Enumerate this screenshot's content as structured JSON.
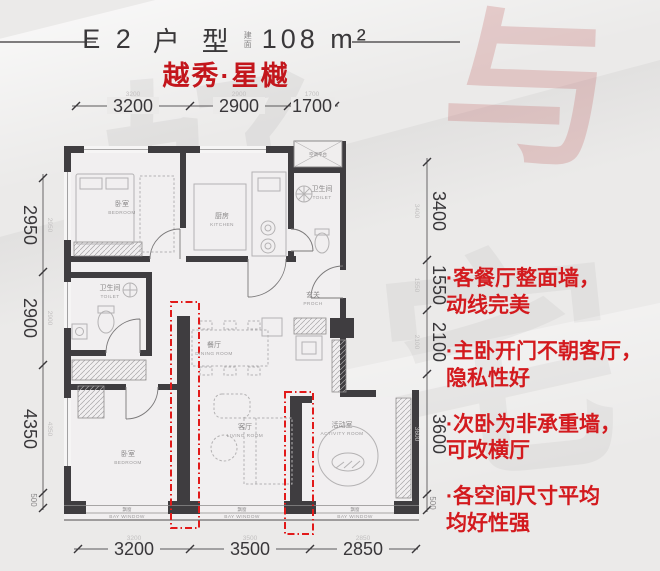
{
  "header": {
    "unit": "E 2",
    "char1": "户",
    "char2": "型",
    "area_label": "建面",
    "area_value": "108 m²",
    "subtitle": "越秀·星樾"
  },
  "dims": {
    "top": [
      "3200",
      "2900",
      "1700"
    ],
    "bottom": [
      "3200",
      "3500",
      "2850"
    ],
    "left": [
      "2950",
      "2900",
      "4350",
      "500"
    ],
    "right": [
      "3400",
      "1550",
      "2100",
      "3600",
      "500"
    ]
  },
  "rooms": {
    "bedroom1": {
      "zh": "卧室",
      "en": "BEDROOM"
    },
    "kitchen": {
      "zh": "厨房",
      "en": "KITCHEN"
    },
    "toilet1": {
      "zh": "卫生间",
      "en": "TOILET"
    },
    "ac": {
      "zh": "空调平台",
      "en": ""
    },
    "toilet2": {
      "zh": "卫生间",
      "en": "TOILET"
    },
    "dining": {
      "zh": "餐厅",
      "en": "DINING ROOM"
    },
    "porch": {
      "zh": "玄关",
      "en": "PROCH"
    },
    "bedroom2": {
      "zh": "卧室",
      "en": "BEDROOM"
    },
    "living": {
      "zh": "客厅",
      "en": "LIVING ROOM"
    },
    "activity": {
      "zh": "活动室",
      "en": "ACTIVITY ROOM"
    },
    "bay1": {
      "zh": "飘窗",
      "en": "BAY WINDOW"
    },
    "bay2": {
      "zh": "飘窗",
      "en": "BAY WINDOW"
    },
    "bay3": {
      "zh": "飘窗",
      "en": "BAY WINDOW"
    }
  },
  "annotations": [
    {
      "l1": "·客餐厅整面墙，",
      "l2": "动线完美"
    },
    {
      "l1": "·主卧开门不朝客厅，",
      "l2": "隐私性好"
    },
    {
      "l1": "·次卧为非承重墙，",
      "l2": "可改横厅"
    },
    {
      "l1": "·各空间尺寸平均",
      "l2": "均好性强"
    }
  ],
  "watermark": [
    "与",
    "好",
    "宅"
  ],
  "colors": {
    "subtitle_red": "#c3161c",
    "annotation_red": "#d31a1e",
    "highlight_red": "#e21a1a",
    "wall": "#3f3d40"
  }
}
